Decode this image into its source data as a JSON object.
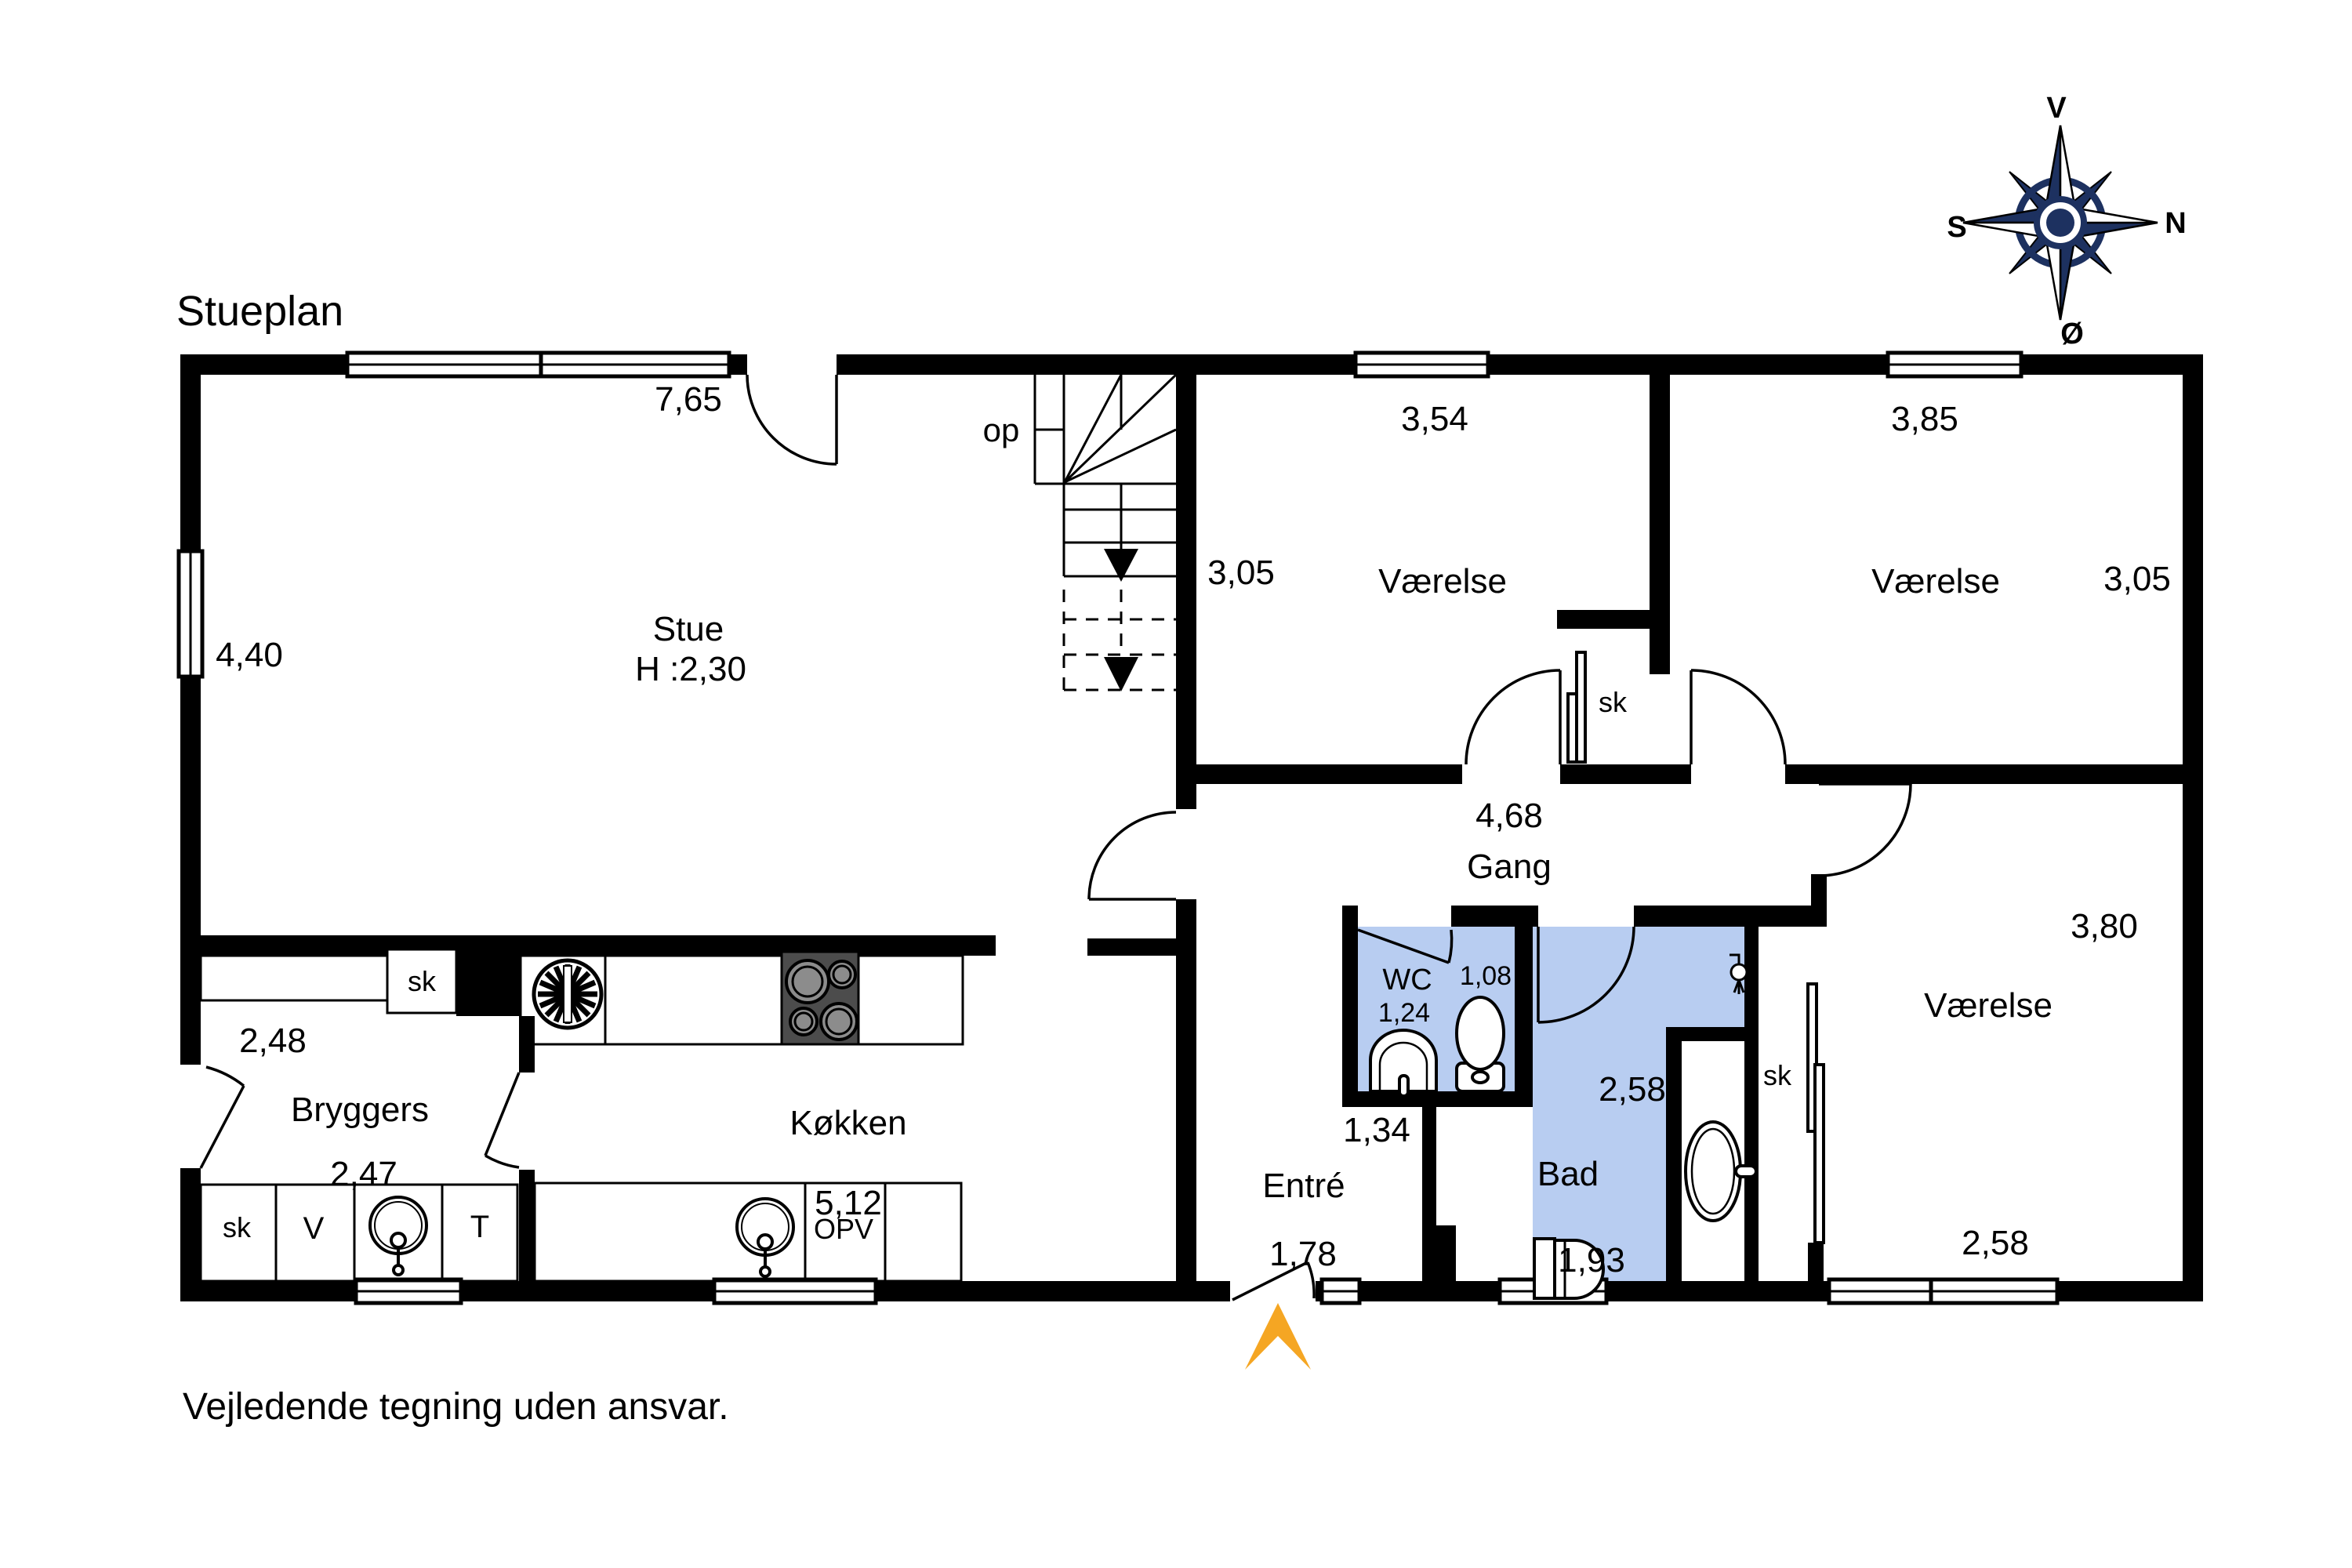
{
  "page": {
    "title": "Stueplan",
    "disclaimer": "Vejledende tegning uden ansvar."
  },
  "compass": {
    "top": "V",
    "right": "N",
    "left": "S",
    "bottom": "Ø"
  },
  "stairs": {
    "up_label": "op"
  },
  "rooms": {
    "stue": {
      "name": "Stue",
      "ceiling": "H :2,30",
      "width": "7,65",
      "depth": "4,40"
    },
    "vaerelse_mid": {
      "name": "Værelse",
      "width": "3,54",
      "depth": "3,05"
    },
    "vaerelse_top_right": {
      "name": "Værelse",
      "width": "3,85",
      "depth": "3,05"
    },
    "gang": {
      "name": "Gang",
      "width": "4,68"
    },
    "hall": {
      "dim_top": "2,28",
      "dim_mid": "2,42"
    },
    "wc": {
      "name": "WC",
      "width": "1,08",
      "depth": "1,24"
    },
    "bad": {
      "name": "Bad",
      "width": "2,58",
      "depth": "1,93"
    },
    "entre": {
      "name": "Entré",
      "width": "1,34",
      "depth": "1,78"
    },
    "bryggers": {
      "name": "Bryggers",
      "width": "2,48",
      "width2": "2,47"
    },
    "koekken": {
      "name": "Køkken",
      "width": "5,12"
    },
    "vaerelse_bottom_right": {
      "name": "Værelse",
      "depth": "3,80",
      "width": "2,58"
    }
  },
  "closets": {
    "bryggers": "sk",
    "mid_room": "sk",
    "right_room": "sk",
    "utility": "sk"
  },
  "appliances": {
    "washer": "V",
    "dryer": "T",
    "dishwasher": "OPV"
  },
  "colors": {
    "wall": "#000000",
    "bath_fill": "#b8cdf1",
    "compass": "#1d3160",
    "entry_arrow": "#f5a623",
    "stove": "#4c4c4c"
  }
}
